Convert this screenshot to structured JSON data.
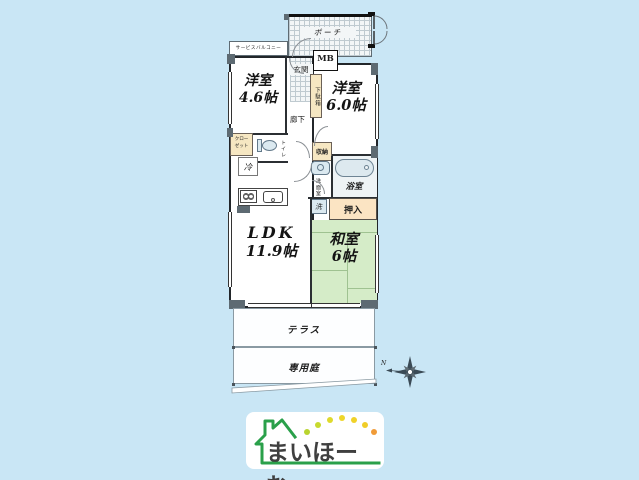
{
  "plan": {
    "rooms": {
      "western1": {
        "name": "洋室",
        "size": "4.6帖"
      },
      "western2": {
        "name": "洋室",
        "size": "6.0帖"
      },
      "ldk": {
        "name": "LDK",
        "size": "11.9帖"
      },
      "washitsu": {
        "name": "和室",
        "size": "6帖"
      }
    },
    "labels": {
      "porch": "ポーチ",
      "mb": "MB",
      "service_balcony": "サービスバルコニー",
      "genkan": "玄関",
      "getabako": "下駄箱",
      "hallway": "廊下",
      "closet_line1": "クロー",
      "closet_line2": "ゼット",
      "toilet": "トイレ",
      "fridge": "冷",
      "storage": "収納",
      "washroom": "洗面室",
      "washer": "洗",
      "bathroom": "浴室",
      "oshiire": "押入",
      "terrace": "テラス",
      "garden": "専用庭"
    },
    "compass": {
      "north_label": "N"
    }
  },
  "logo": {
    "text": "まいほーむ",
    "green": "#2aa04a",
    "text_color": "#3f3f3f",
    "dot_colors": [
      "#b9d42f",
      "#c8da2e",
      "#dfda2c",
      "#eed62a",
      "#f0d229",
      "#f0cd28",
      "#f09b38"
    ]
  },
  "colors": {
    "background": "#c9e6f5",
    "tatami_green": "#d5ecc8",
    "closet_tan": "#f6e7c2",
    "oshiire_peach": "#fbe4c3",
    "bath_blue": "#eef3f5",
    "wall_dark": "#2b2f33"
  }
}
